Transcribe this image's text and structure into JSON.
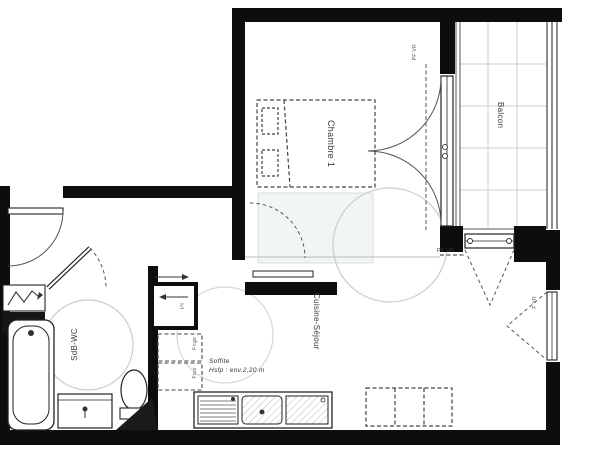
{
  "rooms": {
    "bedroom": {
      "label": "Chambre 1"
    },
    "balcony": {
      "label": "Balcon"
    },
    "living": {
      "label": "Cuisine-Séjour"
    },
    "bathroom": {
      "label": "SdB-WC"
    }
  },
  "openings": {
    "bedroom_balcony_door": {
      "label": "PF VR"
    },
    "living_balcony_door": {
      "label": "PF VR"
    },
    "living_side_window": {
      "label": "F VR"
    },
    "closet": {
      "label": "Pl"
    }
  },
  "appliances": {
    "fridge": {
      "label": "Frigo"
    },
    "oven": {
      "label": "Four"
    }
  },
  "note": {
    "line1": "Soffite",
    "line2": "Hsfp : env.2,20 m"
  },
  "colors": {
    "wall": "#0d0d0d",
    "line": "#2e2e2e",
    "grid": "#c9ced3",
    "turning_circle": "#cccccc"
  }
}
